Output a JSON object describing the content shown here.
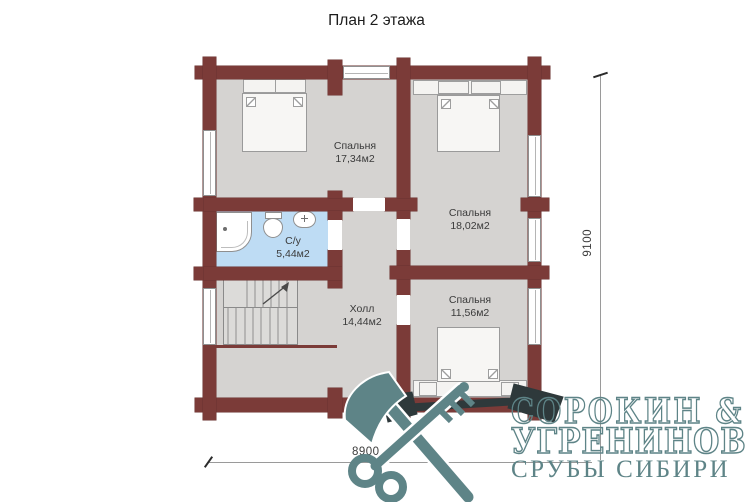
{
  "title": "План 2 этажа",
  "rooms": [
    {
      "name": "Спальня",
      "area": "17,34м2"
    },
    {
      "name": "Спальня",
      "area": "18,02м2"
    },
    {
      "name": "Спальня",
      "area": "11,56м2"
    },
    {
      "name": "С/у",
      "area": "5,44м2"
    },
    {
      "name": "Холл",
      "area": "14,44м2"
    }
  ],
  "dimensions": {
    "width_label": "8900",
    "height_label": "9100"
  },
  "watermark": {
    "line1": "СОРОКИН &",
    "line2": "УГРЕНИНОВ",
    "line3": "СРУБЫ СИБИРИ",
    "icons": [
      "axe-icon",
      "key-icon"
    ]
  },
  "colors": {
    "wall": "#7b3b38",
    "floor": "#d5d3d1",
    "bathroom_floor": "#bedcf4",
    "watermark_teal": "#5e8487",
    "watermark_dark": "#2e393b"
  }
}
